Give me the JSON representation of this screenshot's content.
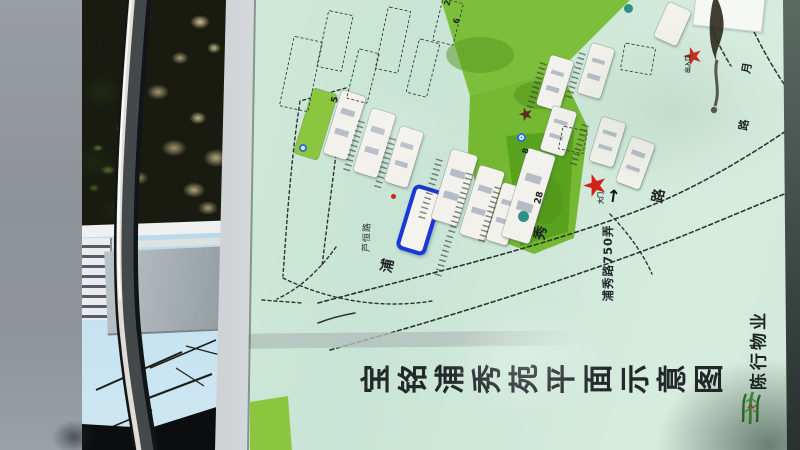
{
  "map": {
    "title": "宝铭浦秀苑平面示意图",
    "property_name": "陈行物业",
    "lane_label": "浦秀路750弄",
    "left_road_label": "芦恒路",
    "colors": {
      "board_green": "#cfe9da",
      "lawn_green": "#7cbf3a",
      "lawn_dark_green": "#58a21e",
      "highlight_blue": "#1839d6",
      "gate_star_red": "#cf2218",
      "building_white": "#f2f1ec"
    },
    "buildings": [
      {
        "type": "green",
        "x": 303,
        "y": 90,
        "w": 25,
        "h": 68,
        "rot": 17
      },
      {
        "type": "white",
        "x": 332,
        "y": 92,
        "w": 25,
        "h": 66,
        "rot": 17
      },
      {
        "type": "white",
        "x": 362,
        "y": 110,
        "w": 25,
        "h": 66,
        "rot": 17
      },
      {
        "type": "white",
        "x": 392,
        "y": 128,
        "w": 24,
        "h": 58,
        "rot": 17
      },
      {
        "type": "highlight",
        "x": 404,
        "y": 186,
        "w": 31,
        "h": 68,
        "rot": 17
      },
      {
        "type": "white",
        "x": 441,
        "y": 151,
        "w": 27,
        "h": 73,
        "rot": 17
      },
      {
        "type": "white",
        "x": 469,
        "y": 167,
        "w": 26,
        "h": 72,
        "rot": 17
      },
      {
        "type": "white",
        "x": 494,
        "y": 184,
        "w": 22,
        "h": 60,
        "rot": 17
      },
      {
        "type": "white",
        "x": 514,
        "y": 150,
        "w": 29,
        "h": 92,
        "rot": 17
      },
      {
        "type": "white",
        "x": 543,
        "y": 57,
        "w": 24,
        "h": 52,
        "rot": 17
      },
      {
        "type": "white",
        "x": 584,
        "y": 45,
        "w": 24,
        "h": 52,
        "rot": 17
      },
      {
        "type": "white",
        "x": 660,
        "y": 5,
        "w": 25,
        "h": 38,
        "rot": 24
      },
      {
        "type": "white",
        "x": 546,
        "y": 108,
        "w": 25,
        "h": 46,
        "rot": 17
      },
      {
        "type": "white",
        "x": 595,
        "y": 119,
        "w": 25,
        "h": 46,
        "rot": 17
      },
      {
        "type": "white",
        "x": 623,
        "y": 139,
        "w": 25,
        "h": 48,
        "rot": 20
      },
      {
        "type": "dashed",
        "x": 286,
        "y": 38,
        "w": 30,
        "h": 72,
        "rot": 12
      },
      {
        "type": "dashed",
        "x": 322,
        "y": 12,
        "w": 26,
        "h": 58,
        "rot": 12
      },
      {
        "type": "dashed",
        "x": 352,
        "y": 50,
        "w": 22,
        "h": 52,
        "rot": 14
      },
      {
        "type": "dashed",
        "x": 381,
        "y": 8,
        "w": 24,
        "h": 64,
        "rot": 12
      },
      {
        "type": "dashed",
        "x": 412,
        "y": 40,
        "w": 22,
        "h": 56,
        "rot": 14
      },
      {
        "type": "dashed",
        "x": 437,
        "y": 0,
        "w": 22,
        "h": 44,
        "rot": 14
      },
      {
        "type": "dashed",
        "x": 622,
        "y": 45,
        "w": 32,
        "h": 28,
        "rot": 10
      },
      {
        "type": "dashed",
        "x": 560,
        "y": 128,
        "w": 26,
        "h": 24,
        "rot": 12
      },
      {
        "type": "parking",
        "x": 350,
        "y": 120,
        "w": 7,
        "h": 55,
        "rot": 17
      },
      {
        "type": "parking",
        "x": 381,
        "y": 137,
        "w": 7,
        "h": 55,
        "rot": 17
      },
      {
        "type": "parking",
        "x": 427,
        "y": 158,
        "w": 7,
        "h": 62,
        "rot": 17
      },
      {
        "type": "parking",
        "x": 457,
        "y": 172,
        "w": 7,
        "h": 62,
        "rot": 17
      },
      {
        "type": "parking",
        "x": 486,
        "y": 186,
        "w": 7,
        "h": 58,
        "rot": 17
      },
      {
        "type": "parking",
        "x": 533,
        "y": 62,
        "w": 7,
        "h": 48,
        "rot": 17
      },
      {
        "type": "parking",
        "x": 572,
        "y": 52,
        "w": 7,
        "h": 48,
        "rot": 17
      },
      {
        "type": "parking",
        "x": 440,
        "y": 235,
        "w": 7,
        "h": 45,
        "rot": 17
      },
      {
        "type": "parking",
        "x": 576,
        "y": 124,
        "w": 7,
        "h": 42,
        "rot": 17
      }
    ],
    "lawns": [
      {
        "points": "440,-4 634,-4 560,70 470,96",
        "color": "#7cbf3a"
      },
      {
        "points": "470,96 560,70 588,128 574,238 534,254 488,236 468,152",
        "color": "#74b931"
      },
      {
        "points": "506,136 574,130 568,232 520,246",
        "color": "#58a21e"
      },
      {
        "points": "250,402 288,396 292,452 250,452",
        "color": "#8cc63f"
      }
    ],
    "lawn_shadows": [
      {
        "cx": 480,
        "cy": 55,
        "rx": 34,
        "ry": 18,
        "color": "#55941e",
        "op": 0.5
      },
      {
        "cx": 540,
        "cy": 95,
        "rx": 26,
        "ry": 14,
        "color": "#4e8f1a",
        "op": 0.45
      },
      {
        "cx": 545,
        "cy": 200,
        "rx": 18,
        "ry": 24,
        "color": "#4e8f1a",
        "op": 0.4
      }
    ],
    "roads": [
      {
        "d": "M 318,303 C 430,273 545,247 650,206 C 705,184 762,148 805,118",
        "dash": "4 3",
        "w": 1.6
      },
      {
        "d": "M 330,350 C 468,312 592,271 680,237 C 732,216 778,196 805,186",
        "dash": "4 3",
        "w": 1.6
      },
      {
        "d": "M 737,-6 C 751,28 769,64 793,97",
        "dash": "4 3",
        "w": 1.5
      },
      {
        "d": "M 699,-6 C 707,18 717,44 731,66",
        "dash": "4 3",
        "w": 1.5
      },
      {
        "d": "M 346,88 L 300,101 C 291,160 287,218 283,276",
        "dash": "3 3",
        "w": 1.4
      },
      {
        "d": "M 344,95 C 336,152 329,210 322,266",
        "dash": "3 3",
        "w": 1.4
      },
      {
        "d": "M 283,278 C 330,301 382,309 432,301",
        "dash": "3 3",
        "w": 1.4
      },
      {
        "d": "M 336,247 C 321,268 301,288 277,299",
        "dash": "3 3",
        "w": 1.4
      },
      {
        "d": "M 610,214 C 628,233 643,253 652,274",
        "dash": "3 3",
        "w": 1.4
      },
      {
        "d": "M 262,300 L 302,303",
        "dash": "3 3",
        "w": 1.4
      },
      {
        "d": "M 318,323 C 331,318 343,315 355,313",
        "dash": "",
        "w": 1.6
      }
    ],
    "icons": [
      {
        "type": "star",
        "x": 597,
        "y": 186,
        "size": 15,
        "color": "#cf2218",
        "name": "gate-star-icon"
      },
      {
        "type": "star",
        "x": 694,
        "y": 56,
        "size": 12,
        "color": "#c42a1e",
        "name": "gate-star-icon"
      },
      {
        "type": "star",
        "x": 527,
        "y": 115,
        "size": 9,
        "color": "#5d2b24",
        "name": "dark-star-icon"
      },
      {
        "type": "star",
        "x": 706,
        "y": 11,
        "size": 10,
        "color": "#cf2218",
        "name": "legend-star-icon"
      },
      {
        "type": "dot-teal",
        "x": 523,
        "y": 216,
        "size": 11,
        "name": "tree-dot-icon"
      },
      {
        "type": "dot-teal",
        "x": 628,
        "y": 8,
        "size": 9,
        "name": "tree-dot-icon"
      },
      {
        "type": "dot-teal",
        "x": 744,
        "y": 9,
        "size": 11,
        "name": "legend-tree-dot-icon"
      },
      {
        "type": "dot-blue",
        "x": 521,
        "y": 137,
        "size": 9,
        "name": "facility-dot-icon"
      },
      {
        "type": "dot-blue",
        "x": 303,
        "y": 148,
        "size": 8,
        "name": "facility-dot-icon"
      },
      {
        "type": "dot-blue",
        "x": 723,
        "y": 9,
        "size": 9,
        "name": "legend-facility-dot-icon"
      },
      {
        "type": "dot-red",
        "x": 393,
        "y": 196,
        "size": 5,
        "name": "marker-dot-icon"
      },
      {
        "type": "arrow-up",
        "x": 612,
        "y": 205,
        "size": 17,
        "name": "gate-arrow-icon"
      }
    ],
    "labels": [
      {
        "text": "5",
        "x": 336,
        "y": 100,
        "size": 9,
        "rot": -75
      },
      {
        "text": "8",
        "x": 526,
        "y": 151,
        "size": 8,
        "rot": -75
      },
      {
        "text": "28",
        "x": 540,
        "y": 198,
        "size": 9,
        "rot": -75
      },
      {
        "text": "2",
        "x": 448,
        "y": 3,
        "size": 8,
        "rot": -75
      },
      {
        "text": "6",
        "x": 457,
        "y": 21,
        "size": 8,
        "rot": -75
      },
      {
        "text": "浦",
        "x": 388,
        "y": 266,
        "size": 14,
        "rot": -78
      },
      {
        "text": "秀",
        "x": 541,
        "y": 233,
        "size": 14,
        "rot": -78
      },
      {
        "text": "路",
        "x": 659,
        "y": 196,
        "size": 14,
        "rot": -78
      },
      {
        "text": "江",
        "x": 725,
        "y": 2,
        "size": 11,
        "rot": -80
      },
      {
        "text": "月",
        "x": 747,
        "y": 68,
        "size": 11,
        "rot": -80
      },
      {
        "text": "路",
        "x": 744,
        "y": 125,
        "size": 11,
        "rot": -80
      },
      {
        "text": "大门",
        "x": 602,
        "y": 198,
        "size": 6,
        "rot": -90
      },
      {
        "text": "出入口",
        "x": 689,
        "y": 64,
        "size": 6,
        "rot": -90
      }
    ]
  }
}
